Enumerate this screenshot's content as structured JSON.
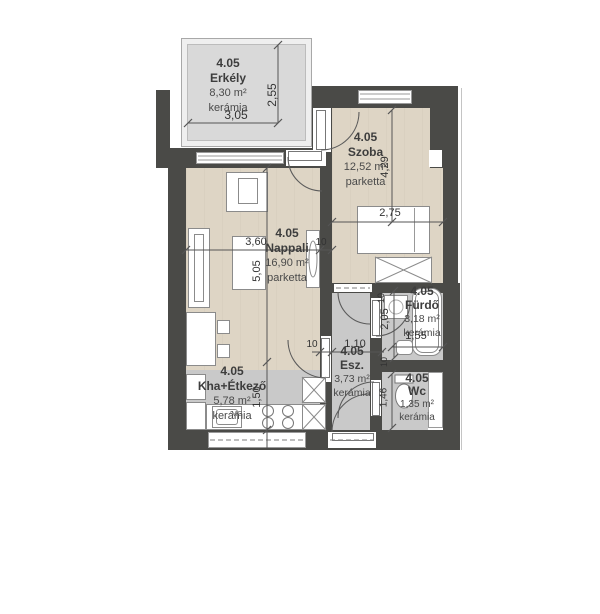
{
  "plan_title": "Lakás alaprajz 4.05",
  "rooms": {
    "erkely": {
      "code": "4.05",
      "name": "Erkély",
      "area": "8,30 m²",
      "floor": "kerámia"
    },
    "szoba": {
      "code": "4.05",
      "name": "Szoba",
      "area": "12,52 m²",
      "floor": "parketta"
    },
    "nappali": {
      "code": "4.05",
      "name": "Nappali",
      "area": "16,90 m²",
      "floor": "parketta"
    },
    "kha": {
      "code": "4.05",
      "name": "Kha+Étkező",
      "area": "5,78 m²",
      "floor": "kerámia"
    },
    "esz": {
      "code": "4.05",
      "name": "Esz.",
      "area": "3,73 m²",
      "floor": "kerámia"
    },
    "furdo": {
      "code": "4.05",
      "name": "Fürdő",
      "area": "3,18 m²",
      "floor": "kerámia"
    },
    "wc": {
      "code": "4.05",
      "name": "Wc",
      "area": "1,35 m²",
      "floor": "kerámia"
    }
  },
  "dims": {
    "balcony_w": "3,05",
    "balcony_h": "2,55",
    "nappali_w": "3,60",
    "nappali_h": "5,05",
    "szoba_w": "2,75",
    "szoba_h": "4,29",
    "kitchen_h": "1,50",
    "esz_w": "1,10",
    "furdo_h": "2,05",
    "furdo_w": "1,55",
    "wc_h": "1,46",
    "wall_10_a": "10",
    "wall_10_b": "10",
    "wall_10_c": "10",
    "wall_10_d": "10"
  },
  "fixtures": {
    "sink_label": "MG"
  },
  "colors": {
    "wall": "#4a4a47",
    "parquet": "#ded5c5",
    "ceramic": "#c9c9c9",
    "balcony_floor": "#d9d9d9"
  }
}
